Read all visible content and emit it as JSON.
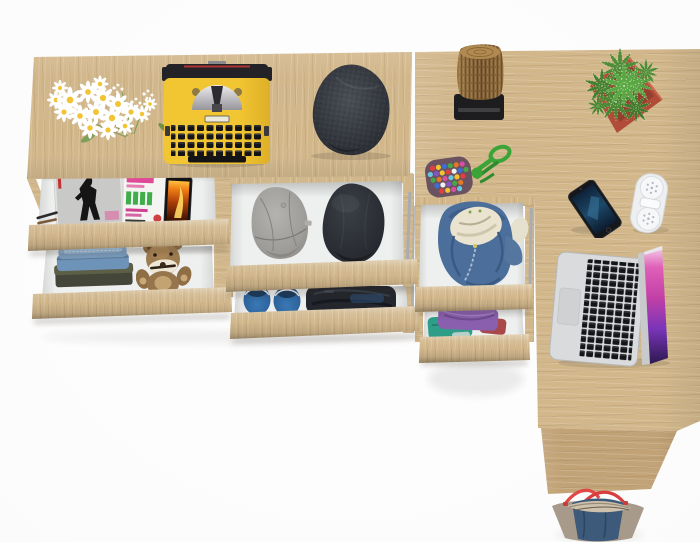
{
  "scene": {
    "kind": "product-photo",
    "description": "Top-down view of a light sonoma-oak corner desk and dresser with six open drawers, styled with clothes and desk accessories on a white background",
    "view": "top-down",
    "background": "#fbfbfb"
  },
  "colors": {
    "wood": "#d2b78b",
    "woodDark": "#c2a377",
    "drawerInterior": "#eef0ef",
    "metalSlide": "#a8adb2",
    "typewriterYellow": "#f2c532",
    "typewriterBlack": "#232327",
    "flatCap": "#383c43",
    "grayCap": "#a7a5a2",
    "blackCap": "#2b2e33",
    "logBrown": "#8f6c40",
    "standBlack": "#1d1d1f",
    "potRed": "#b04c38",
    "plantGreen": "#4e8c38",
    "pouchGreen": "#3aa437",
    "pouchBase": "#6a5260",
    "phoneScreenBlue": "#1d4868",
    "headphoneWhite": "#edeff1",
    "laptopSilver": "#d9dbdd",
    "laptopScreenMagenta": "#c03fa6",
    "hoodieBlue": "#4b6e9b",
    "hoodieLining": "#e9e3cf",
    "jeansBlue": "#6e93b8",
    "teddyBrown": "#9d7b50",
    "shoeBlue": "#2e68a4",
    "darkClothes": "#23262d",
    "purpleShirt": "#8a5fae",
    "tealShirt": "#2f9e88",
    "redShirt": "#a84848",
    "bagDenim": "#3d5a7a",
    "bagTaupe": "#a89a8b",
    "bagStrap": "#e04848",
    "magazinePink": "#e04898",
    "magazineGreen": "#3fae4a",
    "fireOrange": "#f08018",
    "daisyCenter": "#f2c433",
    "stemGreen": "#7a9a5a"
  },
  "furniture": {
    "parts": [
      {
        "id": "left-console-top",
        "label": "long console top, oak"
      },
      {
        "id": "right-desk-top",
        "label": "desk return top, oak"
      },
      {
        "id": "side-panel",
        "label": "desk side panel, oak"
      },
      {
        "id": "drawer-left-1",
        "label": "open drawer with magazines and phone"
      },
      {
        "id": "drawer-left-2",
        "label": "open drawer with jeans and teddy bear"
      },
      {
        "id": "drawer-mid-1",
        "label": "open drawer with two caps"
      },
      {
        "id": "drawer-mid-2",
        "label": "open drawer with blue shoes and dark clothes"
      },
      {
        "id": "drawer-right-1",
        "label": "open drawer with blue hoodie"
      },
      {
        "id": "drawer-right-2",
        "label": "open drawer with folded shirts"
      }
    ]
  },
  "props": [
    {
      "id": "flowers",
      "label": "white daisy bouquet overhanging console edge"
    },
    {
      "id": "typewriter",
      "label": "vintage yellow typewriter with black keys"
    },
    {
      "id": "flat-cap",
      "label": "dark tweed flat cap"
    },
    {
      "id": "log-stool",
      "label": "wooden log on black stand"
    },
    {
      "id": "potted-plant",
      "label": "green succulent in square terracotta pot"
    },
    {
      "id": "bead-pouch",
      "label": "multicolor bead pouch with green cord"
    },
    {
      "id": "smartphone",
      "label": "smartphone with dark blue screen"
    },
    {
      "id": "headphones",
      "label": "folded white headphones"
    },
    {
      "id": "laptop",
      "label": "silver laptop open, magenta wallpaper"
    },
    {
      "id": "tote-bag",
      "label": "denim and taupe tote bag with red straps"
    },
    {
      "id": "magazine-bw",
      "label": "black and white fashion magazine"
    },
    {
      "id": "magazine-color",
      "label": "magazine with pink and green cover text"
    },
    {
      "id": "drawer-phone",
      "label": "phone with orange flame wallpaper"
    },
    {
      "id": "pencils",
      "label": "pencils in drawer corner"
    },
    {
      "id": "jeans-stack",
      "label": "folded blue jeans"
    },
    {
      "id": "teddy-bear",
      "label": "brown teddy bear with white snout"
    },
    {
      "id": "gray-cap",
      "label": "heather gray army cap"
    },
    {
      "id": "black-cap",
      "label": "black army cap"
    },
    {
      "id": "blue-shoes",
      "label": "pair of blue slip-on shoes"
    },
    {
      "id": "dark-clothes",
      "label": "folded dark navy clothes"
    },
    {
      "id": "blue-hoodie",
      "label": "blue zip hoodie with cream lining"
    },
    {
      "id": "folded-shirts",
      "label": "folded purple, teal and red shirts"
    }
  ]
}
